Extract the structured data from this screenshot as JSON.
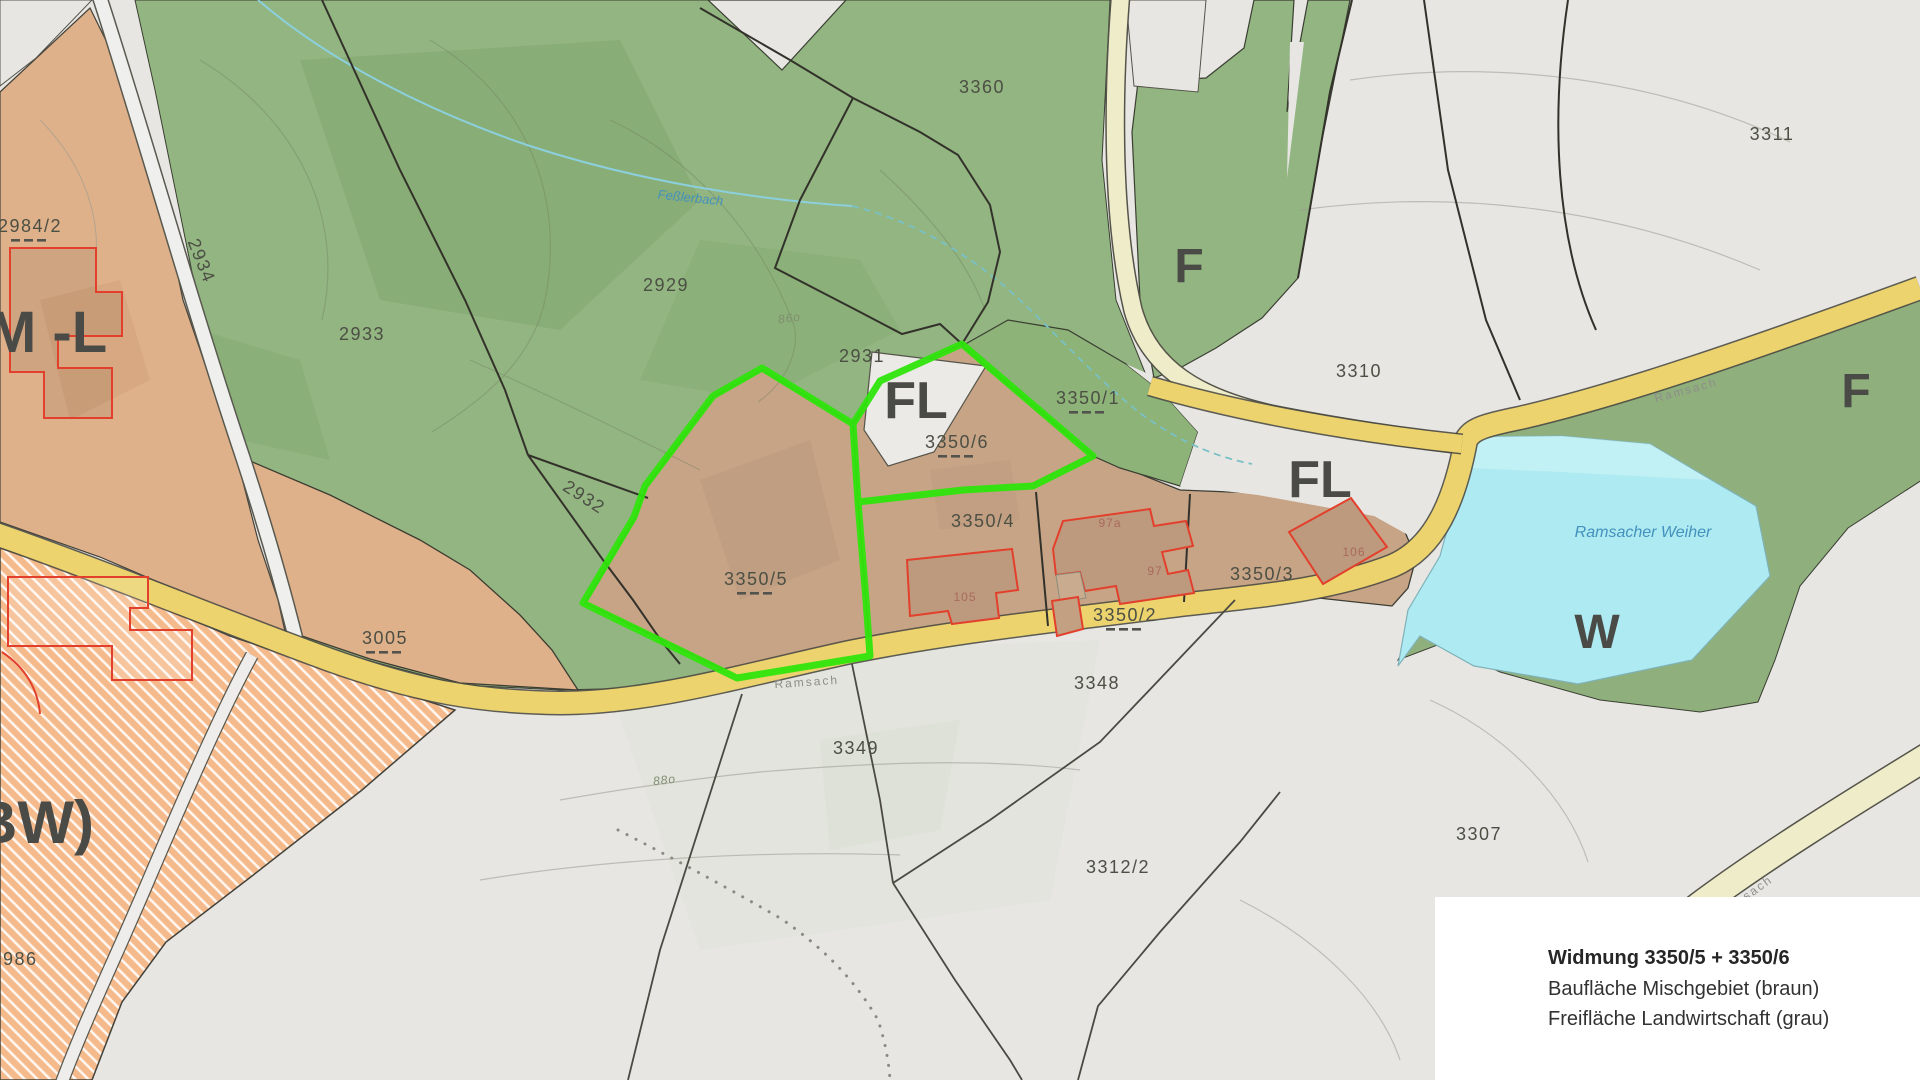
{
  "title": "Zoning map (Flächenwidmungsplan) excerpt",
  "legend": {
    "title": "Widmung 3350/5 + 3350/6",
    "line1": "Baufläche Mischgebiet (braun)",
    "line2": "Freifläche Landwirtschaft (grau)"
  },
  "colors": {
    "forest_green": "#93b581",
    "parcel_brown": "#c8a486",
    "left_tan": "#dfb18a",
    "agriculture_gray": "#e7e6e3",
    "residential_orange": "#f5ba8c",
    "road_yellow": "#ecd36e",
    "road_cream": "#efecca",
    "water_cyan": "#aeeaf1",
    "highlight_green": "#2fe50c",
    "building_red": "#e2402c"
  },
  "labels": [
    {
      "t": "2984/2",
      "x": 30,
      "y": 232,
      "cls": "parcel",
      "dashed": true
    },
    {
      "t": "2934",
      "x": 196,
      "y": 263,
      "cls": "parcel",
      "rot": 68,
      "size": 17
    },
    {
      "t": "2933",
      "x": 362,
      "y": 340,
      "cls": "parcel"
    },
    {
      "t": "2929",
      "x": 666,
      "y": 291,
      "cls": "parcel"
    },
    {
      "t": "3360",
      "x": 982,
      "y": 93,
      "cls": "parcel"
    },
    {
      "t": "2931",
      "x": 862,
      "y": 362,
      "cls": "parcel"
    },
    {
      "t": "2932",
      "x": 581,
      "y": 502,
      "cls": "parcel",
      "rot": 33,
      "size": 16
    },
    {
      "t": "3350/1",
      "x": 1088,
      "y": 404,
      "cls": "parcel",
      "dashed": true
    },
    {
      "t": "3350/6",
      "x": 957,
      "y": 448,
      "cls": "parcel",
      "dashed": true
    },
    {
      "t": "3350/5",
      "x": 756,
      "y": 585,
      "cls": "parcel",
      "size": 20,
      "dashed": true
    },
    {
      "t": "3350/4",
      "x": 983,
      "y": 527,
      "cls": "parcel"
    },
    {
      "t": "3350/2",
      "x": 1125,
      "y": 621,
      "cls": "parcel",
      "dashed": true
    },
    {
      "t": "3350/3",
      "x": 1262,
      "y": 580,
      "cls": "parcel"
    },
    {
      "t": "3005",
      "x": 385,
      "y": 644,
      "cls": "parcel",
      "dashed": true
    },
    {
      "t": "3310",
      "x": 1359,
      "y": 377,
      "cls": "parcel"
    },
    {
      "t": "3311",
      "x": 1772,
      "y": 140,
      "cls": "parcel"
    },
    {
      "t": "3348",
      "x": 1097,
      "y": 689,
      "cls": "parcel"
    },
    {
      "t": "3349",
      "x": 856,
      "y": 754,
      "cls": "parcel"
    },
    {
      "t": "3312/2",
      "x": 1118,
      "y": 873,
      "cls": "parcel"
    },
    {
      "t": "3307",
      "x": 1479,
      "y": 840,
      "cls": "parcel"
    },
    {
      "t": "986",
      "x": 3,
      "y": 965,
      "cls": "parcel",
      "anchor": "start"
    },
    {
      "t": "M -L",
      "x": -12,
      "y": 352,
      "cls": "zone",
      "size": 58,
      "anchor": "start"
    },
    {
      "t": "BW)",
      "x": -26,
      "y": 843,
      "cls": "zone",
      "size": 60,
      "anchor": "start"
    },
    {
      "t": "F",
      "x": 1189,
      "y": 282,
      "cls": "zone",
      "size": 48
    },
    {
      "t": "F",
      "x": 1856,
      "y": 407,
      "cls": "zone",
      "size": 48
    },
    {
      "t": "FL",
      "x": 916,
      "y": 418,
      "cls": "zone",
      "size": 52
    },
    {
      "t": "FL",
      "x": 1320,
      "y": 497,
      "cls": "zone",
      "size": 52
    },
    {
      "t": "W",
      "x": 1597,
      "y": 648,
      "cls": "zone",
      "size": 48
    },
    {
      "t": "105",
      "x": 965,
      "y": 601,
      "cls": "bldg"
    },
    {
      "t": "97a",
      "x": 1110,
      "y": 527,
      "cls": "bldg",
      "size": 11
    },
    {
      "t": "97",
      "x": 1155,
      "y": 575,
      "cls": "bldg",
      "size": 11
    },
    {
      "t": "106",
      "x": 1354,
      "y": 556,
      "cls": "bldg",
      "size": 11
    },
    {
      "t": "Feßlerbach",
      "x": 690,
      "y": 202,
      "cls": "water",
      "rot": 6,
      "size": 13
    },
    {
      "t": "Ramsacher Weiher",
      "x": 1643,
      "y": 537,
      "cls": "water",
      "size": 16,
      "color": "#5a93b0"
    },
    {
      "t": "Ramsach",
      "x": 807,
      "y": 686,
      "cls": "roadlbl",
      "rot": -4
    },
    {
      "t": "Ramsach",
      "x": 1687,
      "y": 394,
      "cls": "roadlbl",
      "rot": -15,
      "color": "#a39040"
    },
    {
      "t": "sach",
      "x": 1760,
      "y": 891,
      "cls": "roadlbl",
      "rot": -36,
      "color": "#a39040"
    },
    {
      "t": "86o",
      "x": 790,
      "y": 322,
      "cls": "contourlbl",
      "rot": -8
    },
    {
      "t": "88o",
      "x": 665,
      "y": 784,
      "cls": "contourlbl",
      "rot": -7,
      "color": "#9a9a92"
    }
  ]
}
